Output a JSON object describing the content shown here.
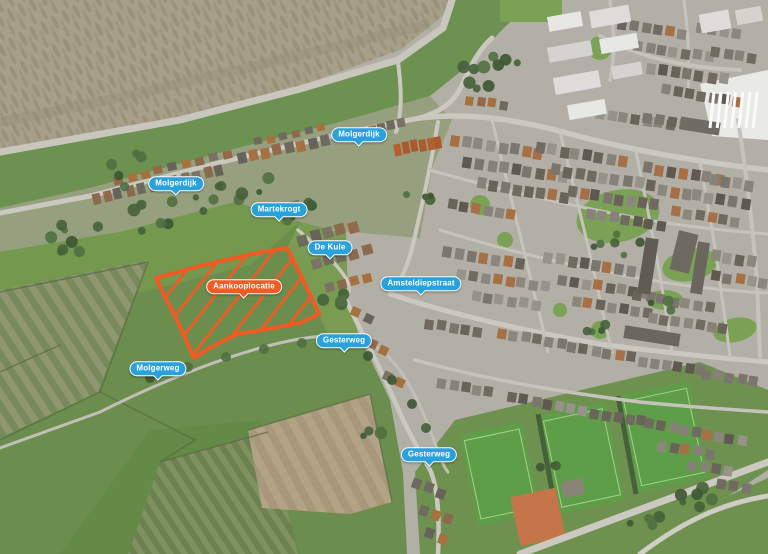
{
  "map": {
    "pins": [
      {
        "id": "molgerdijk-north",
        "text": "Molgerdijk",
        "style": "street",
        "x": 359,
        "y": 136
      },
      {
        "id": "molgerdijk-west",
        "text": "Molgerdijk",
        "style": "street",
        "x": 176,
        "y": 185
      },
      {
        "id": "martekrogt",
        "text": "Martekrogt",
        "style": "street",
        "x": 279,
        "y": 211
      },
      {
        "id": "de-kule",
        "text": "De Kule",
        "style": "street",
        "x": 330,
        "y": 249
      },
      {
        "id": "aankooplocatie",
        "text": "Aankooplocatie",
        "style": "highlight",
        "x": 244,
        "y": 288
      },
      {
        "id": "amsteldiepstraat",
        "text": "Amsteldiepstraat",
        "style": "street",
        "x": 421,
        "y": 285
      },
      {
        "id": "gesterweg-north",
        "text": "Gesterweg",
        "style": "street",
        "x": 344,
        "y": 342
      },
      {
        "id": "molgerweg",
        "text": "Molgerweg",
        "style": "street",
        "x": 158,
        "y": 370
      },
      {
        "id": "gesterweg-south",
        "text": "Gesterweg",
        "style": "street",
        "x": 429,
        "y": 456
      }
    ],
    "highlight_area": {
      "label": "Aankooplocatie",
      "points": [
        [
          156,
          278
        ],
        [
          200,
          266
        ],
        [
          252,
          254
        ],
        [
          287,
          248
        ],
        [
          303,
          280
        ],
        [
          319,
          314
        ],
        [
          300,
          323
        ],
        [
          262,
          330
        ],
        [
          237,
          334
        ],
        [
          213,
          346
        ],
        [
          194,
          358
        ],
        [
          176,
          318
        ],
        [
          163,
          293
        ]
      ],
      "stroke_width": 4,
      "hatch": true
    },
    "colors": {
      "pin_blue": "#29a2dc",
      "pin_orange": "#f15a24",
      "pin_text": "#ffffff",
      "highlight": "#f15a24"
    }
  }
}
